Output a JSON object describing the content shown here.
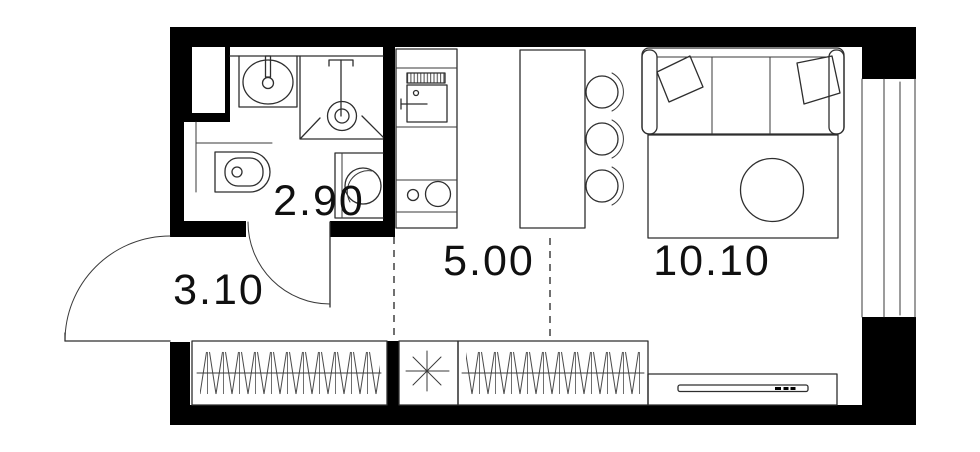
{
  "plan": {
    "type": "studio-apartment-floor-plan",
    "rooms": {
      "bathroom": {
        "area": "2.90"
      },
      "hallway": {
        "area": "3.10"
      },
      "kitchen": {
        "area": "5.00"
      },
      "living": {
        "area": "10.10"
      }
    },
    "symbols": {
      "utility_star": "✳"
    },
    "colors": {
      "wall": "#000000",
      "furniture_line": "#2e2e2e",
      "label": "#101010",
      "background": "#ffffff"
    }
  }
}
